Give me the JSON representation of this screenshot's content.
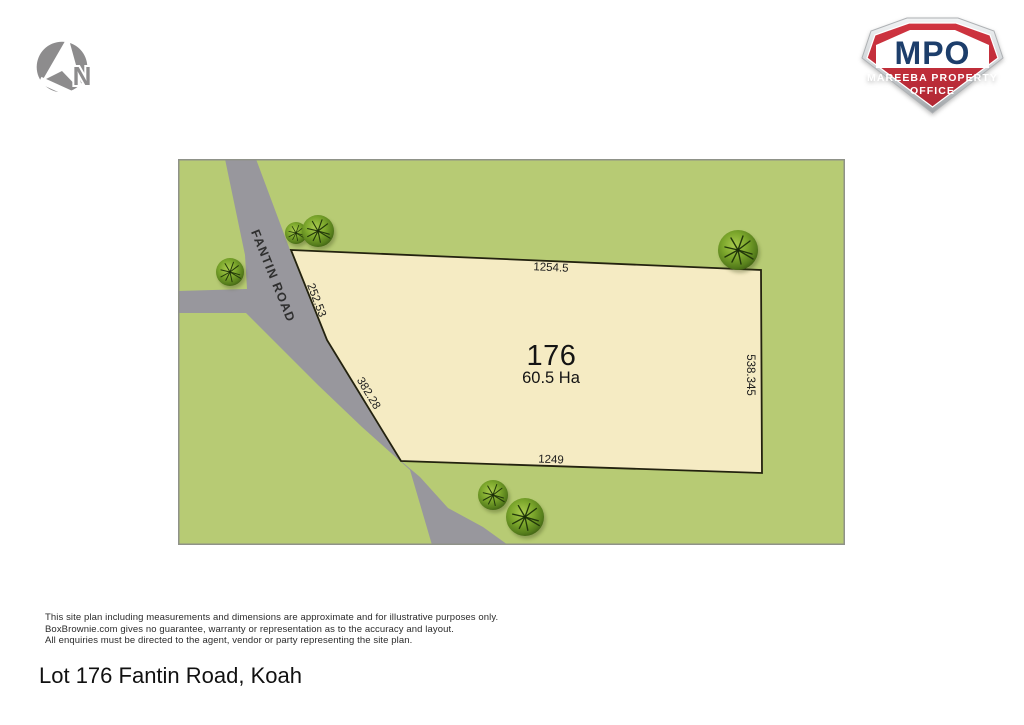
{
  "north": {
    "label": "N"
  },
  "logo": {
    "acronym": "MPO",
    "line1": "MAREEBA PROPERTY",
    "line2": "OFFICE",
    "colors": {
      "red": "#c42f3b",
      "navy": "#1d3e6b",
      "silver": "#d7dadc"
    }
  },
  "plan": {
    "road_name": "FANTIN ROAD",
    "lot_number": "176",
    "lot_area": "60.5 Ha",
    "dim_top": "1254.5",
    "dim_right": "538.345",
    "dim_bottom": "1249",
    "dim_road_upper": "252.53",
    "dim_road_lower": "382.28",
    "colors": {
      "grass": "#b7cb74",
      "road": "#98979d",
      "lot": "#f5ebc3",
      "lot_border": "#23220f"
    }
  },
  "footer": {
    "disclaimer": [
      "This site plan including measurements and dimensions are approximate and for illustrative purposes only.",
      "BoxBrownie.com gives no guarantee, warranty or representation as to the accuracy and layout.",
      "All enquiries must be directed to the agent, vendor or party representing the site plan."
    ],
    "title": "Lot 176 Fantin Road, Koah"
  }
}
